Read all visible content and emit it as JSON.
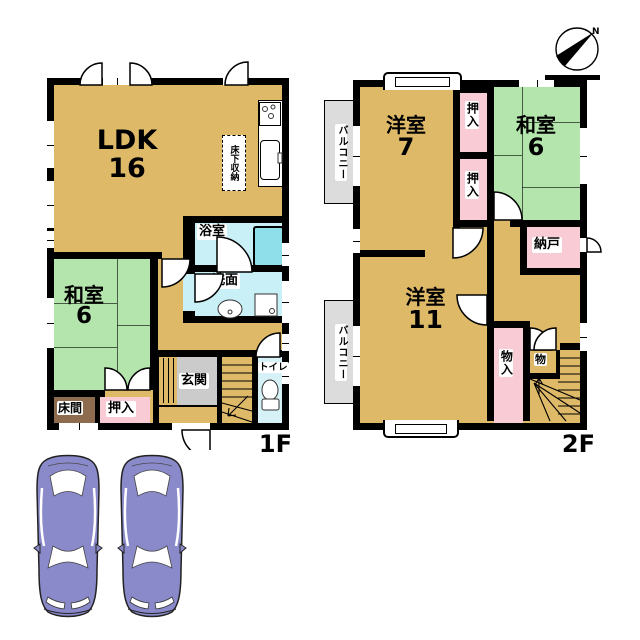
{
  "palette": {
    "floor_tan": "#DDB968",
    "tatami_green": "#B4E5AC",
    "closet_pink": "#F9CBD4",
    "wet_room_cyan": "#C9F0F6",
    "bathtub_cyan": "#8FDFEB",
    "entrance_gray": "#CBCBCB",
    "balcony_gray": "#DCDCDC",
    "tokonoma_brown": "#8C6B4E",
    "car_purple": "#8A8ACB",
    "wall_black": "#000000"
  },
  "floor1": {
    "floor_label": "1F",
    "ldk": {
      "name": "LDK",
      "size": "16"
    },
    "washitsu": {
      "name": "和室",
      "size": "6"
    },
    "underfloor_storage": "床下収納",
    "bathroom": "浴室",
    "washroom": "洗面",
    "toilet": "トイレ",
    "entrance": "玄関",
    "tokonoma": "床間",
    "oshiire": "押入"
  },
  "floor2": {
    "floor_label": "2F",
    "yoshitsu7": {
      "name": "洋室",
      "size": "7"
    },
    "washitsu": {
      "name": "和室",
      "size": "6"
    },
    "oshiire_upper": "押入",
    "oshiire_lower": "押入",
    "nando": "納戸",
    "yoshitsu11": {
      "name": "洋室",
      "size": "11"
    },
    "monoire": "物入",
    "mono": "物",
    "balcony_upper": "バルコニー",
    "balcony_lower": "バルコニー"
  },
  "compass": {
    "north_label": "N"
  },
  "icons": {
    "compass": "north-compass-icon",
    "stove": "stove-burner-icon",
    "kitchen_sink": "kitchen-sink-icon",
    "washbasin": "washbasin-icon",
    "washing_machine": "washing-machine-icon",
    "toilet": "toilet-icon",
    "bathtub": "bathtub-icon",
    "stairs": "stairs-icon",
    "cars": "car-top-view-icon"
  }
}
